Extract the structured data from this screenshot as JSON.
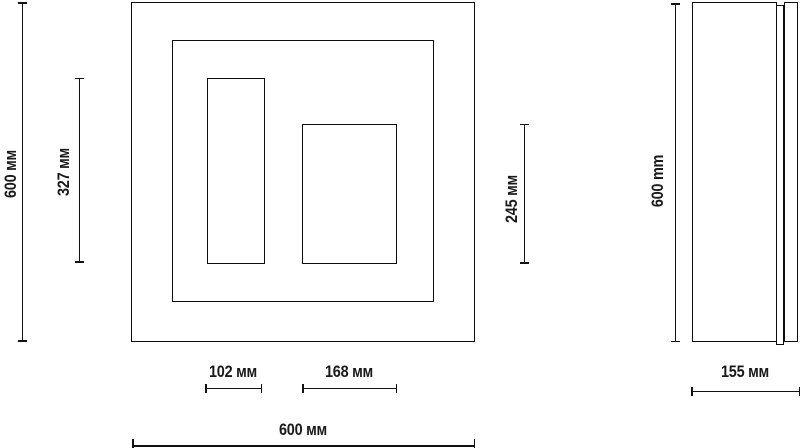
{
  "page": {
    "background_color": "#ffffff",
    "line_color": "#0c0c0c",
    "text_color": "#1a1a1a"
  },
  "front_view": {
    "description": "front elevation: outer frame, inner frame, two inner cutouts",
    "dimensions": {
      "overall_height": "600 мм",
      "left_cutout_height": "327 мм",
      "right_cutout_height": "245 мм",
      "left_cutout_width": "102 мм",
      "right_cutout_width": "168 мм",
      "overall_width": "600 мм"
    }
  },
  "side_view": {
    "description": "side elevation: body, groove strip, back panel",
    "dimensions": {
      "overall_height": "600 mm",
      "overall_depth": "155 мм"
    }
  }
}
